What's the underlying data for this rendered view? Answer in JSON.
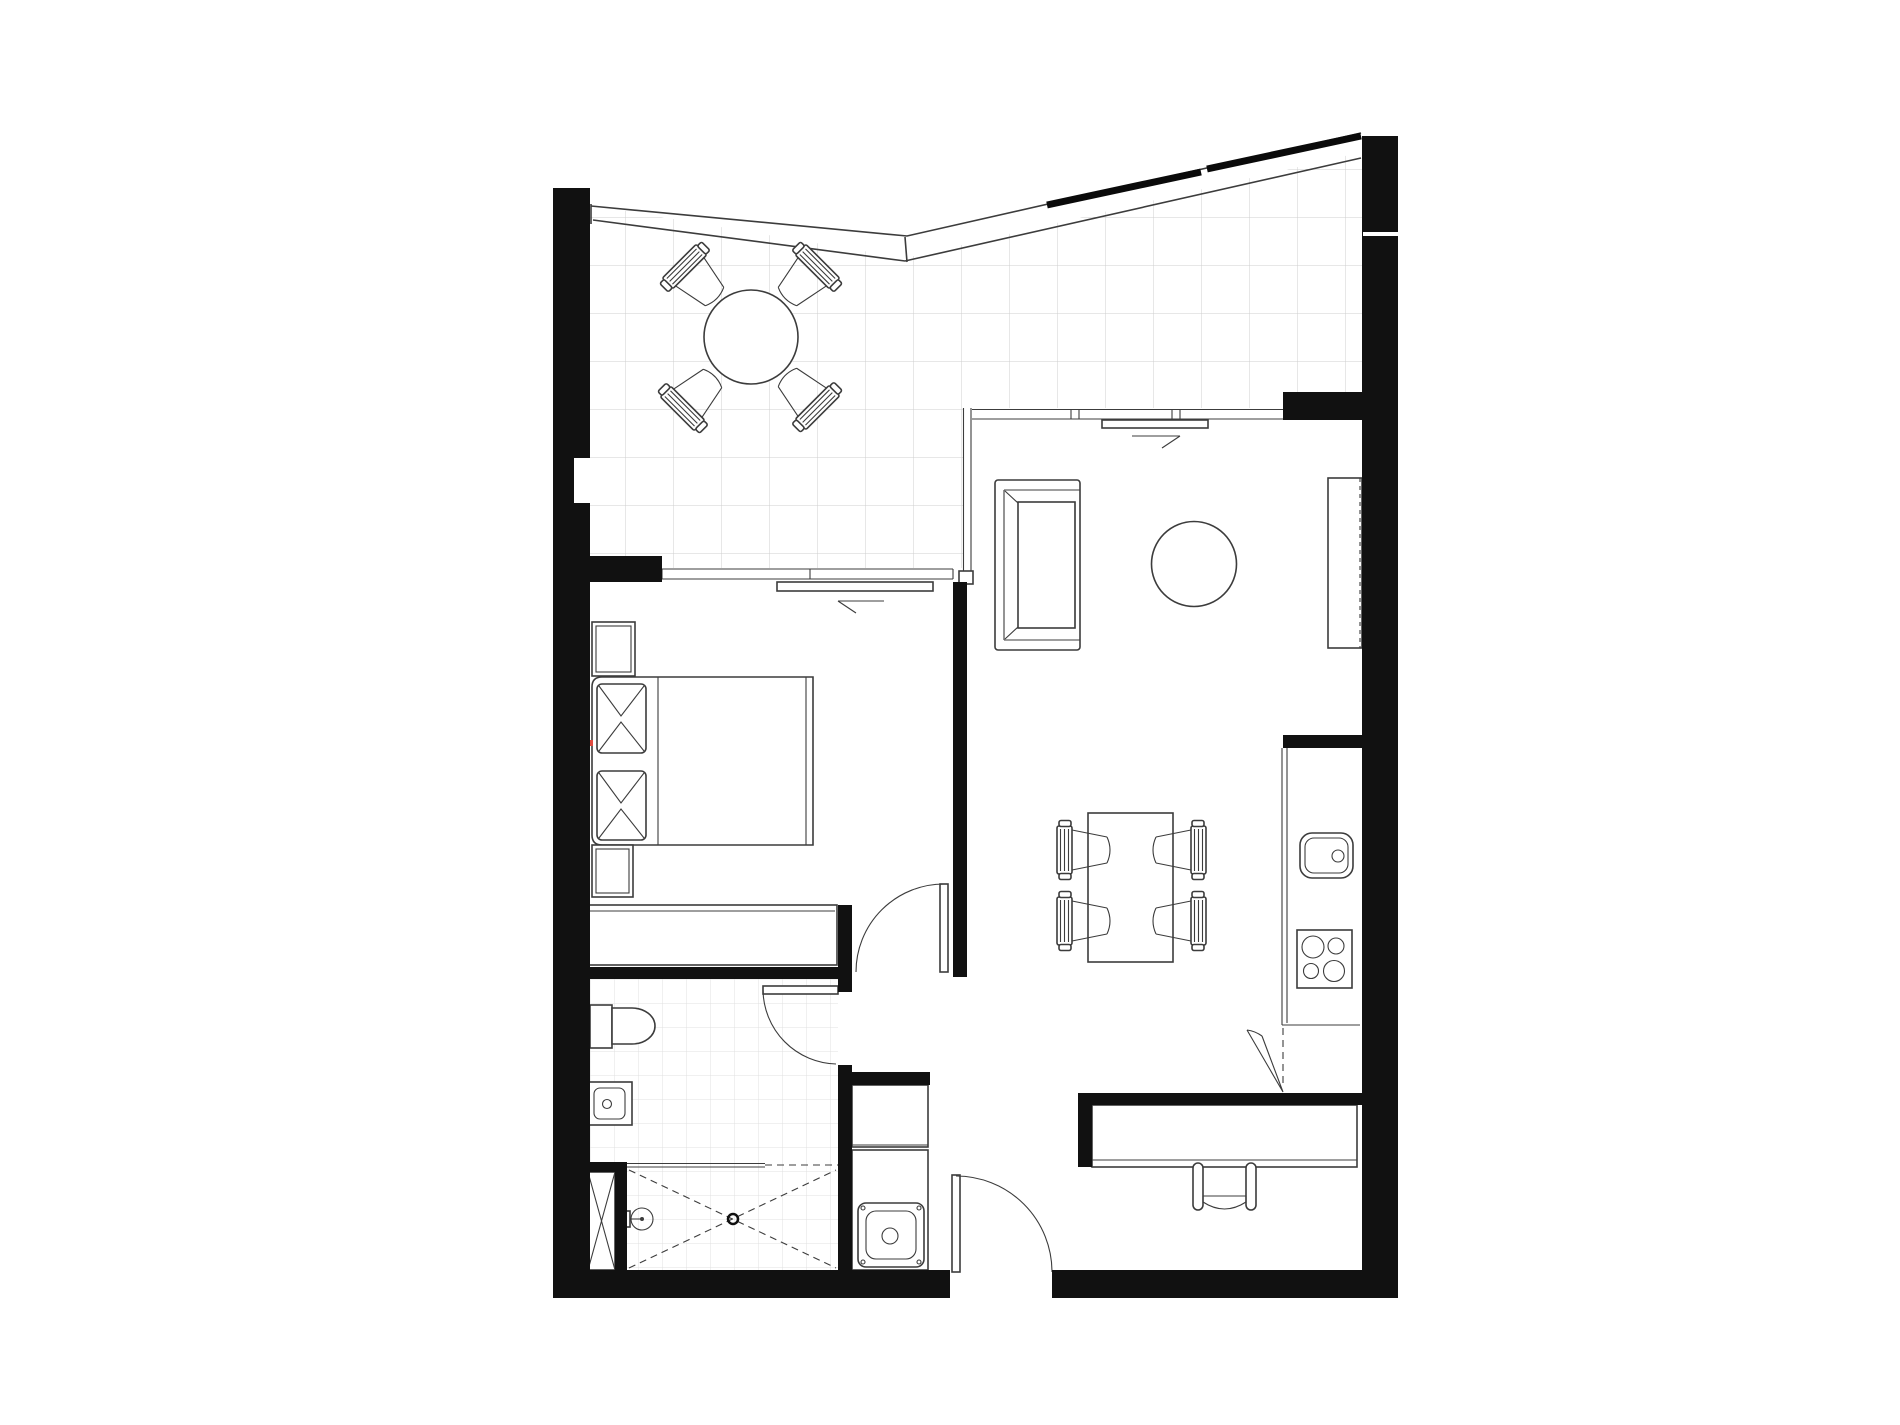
{
  "document": {
    "kind": "architectural floor plan",
    "description": "Black and white one-bedroom apartment floor plan with wrap-around balcony, no text labels or dimensions visible",
    "visible_text": []
  },
  "colors": {
    "background": "#ffffff",
    "walls": "#111111",
    "furniture_lines": "#3c3c3c",
    "balcony_tile_grid": "#cfcfcf",
    "bathroom_tile_grid": "#e0e0e0",
    "accent_mark_red": "#e04a3f"
  },
  "rooms": [
    {
      "name": "balcony",
      "floor": "large tile grid",
      "features": [
        "sloped perimeter railing",
        "roof edge dashes",
        "round outdoor table",
        "4 outdoor chairs"
      ]
    },
    {
      "name": "bedroom",
      "features": [
        "double bed with 2 pillows",
        "2 nightstands",
        "built-in wardrobe",
        "sliding glass door to balcony",
        "swing door to hallway",
        "red section mark on west wall"
      ]
    },
    {
      "name": "living-dining-kitchen",
      "features": [
        "2-seat sofa",
        "round rug",
        "tv cabinet",
        "dining table with 4 chairs",
        "kitchen counter with sink and 4-burner hob",
        "corner cabinet",
        "desk with office chair",
        "sliding glass door to balcony"
      ]
    },
    {
      "name": "bathroom",
      "floor": "small tile grid",
      "features": [
        "toilet",
        "washbasin",
        "walk-in shower with floor drain and hand shower",
        "service duct shaft",
        "inward swing door"
      ]
    },
    {
      "name": "hallway-entry",
      "features": [
        "entry swing door in south wall",
        "laundry closet with tall cabinet and steel sink"
      ]
    }
  ],
  "furniture": {
    "balcony": [
      "round-table",
      "chair-nw",
      "chair-ne",
      "chair-sw",
      "chair-se"
    ],
    "bedroom": [
      "bed",
      "pillow-1",
      "pillow-2",
      "nightstand-top",
      "nightstand-bottom",
      "wardrobe"
    ],
    "living": [
      "sofa",
      "round-rug",
      "tv-cabinet",
      "dining-table",
      "dining-chair-1",
      "dining-chair-2",
      "dining-chair-3",
      "dining-chair-4",
      "desk",
      "desk-chair"
    ],
    "kitchen": [
      "counter",
      "kitchen-sink",
      "hob-4-burners",
      "corner-cabinet"
    ],
    "bathroom": [
      "toilet",
      "washbasin",
      "shower",
      "floor-drain",
      "hand-shower",
      "duct-shaft"
    ],
    "laundry": [
      "tall-cabinet",
      "laundry-sink"
    ]
  },
  "openings": {
    "doors": [
      "bedroom-swing-door",
      "bathroom-swing-door",
      "entry-swing-door"
    ],
    "sliding_doors": [
      "bedroom-balcony-slider",
      "living-balcony-slider"
    ],
    "slider_arrows": [
      "bedroom-slider-arrow-left",
      "living-slider-arrow-right"
    ]
  }
}
